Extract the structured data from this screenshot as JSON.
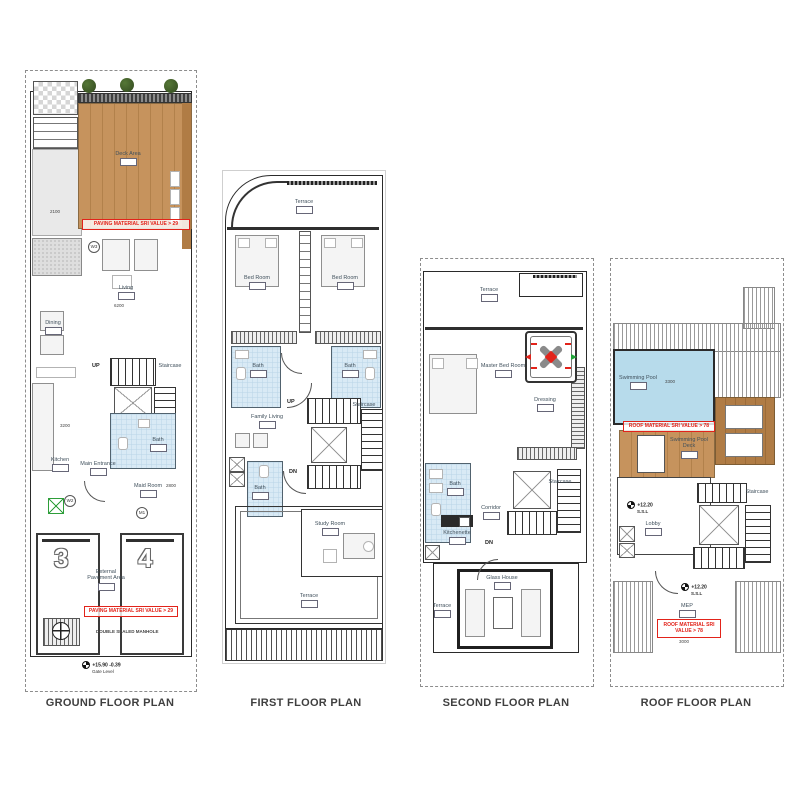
{
  "titles": {
    "ground": "GROUND FLOOR PLAN",
    "first": "FIRST FLOOR PLAN",
    "second": "SECOND FLOOR PLAN",
    "roof": "ROOF FLOOR PLAN"
  },
  "ground": {
    "deck_area": "Deck Area",
    "living": "Living",
    "dining": "Dining",
    "kitchen": "Kitchen",
    "main_entrance": "Main Entrance",
    "bath": "Bath",
    "maid_room": "Maid Room",
    "staircase": "Staircase",
    "up": "UP",
    "parking_3": "3",
    "parking_4": "4",
    "external_pavement": "External Pavement Area",
    "manhole_note": "DOUBLE SEALED MANHOLE",
    "paving_note": "PAVING MATERIAL SRI VALUE > 29",
    "paving_note_2": "PAVING MATERIAL SRI VALUE > 29",
    "level": "+15.90  -0.39",
    "level_sub": "Gate Level",
    "tag_w3": "W3",
    "tag_w2": "W2",
    "tag_m1": "M1",
    "dim_a": "2100",
    "dim_b": "6200",
    "dim_c": "3200",
    "dim_d": "2800"
  },
  "first": {
    "terrace_top": "Terrace",
    "bedroom_l": "Bed Room",
    "bedroom_r": "Bed Room",
    "bath_l": "Bath",
    "bath_r": "Bath",
    "family_living": "Family Living",
    "bath_s": "Bath",
    "study": "Study Room",
    "terrace_bottom": "Terrace",
    "staircase": "Staircase",
    "up": "UP",
    "dn": "DN"
  },
  "second": {
    "terrace_top": "Terrace",
    "master": "Master Bed Room",
    "dressing": "Dressing",
    "bath": "Bath",
    "corridor": "Corridor",
    "kitchenette": "Kitchenette",
    "staircase": "Staircase",
    "dn": "DN",
    "glass_house": "Glass House",
    "terrace_side": "Terrace"
  },
  "roof": {
    "pool": "Swimming Pool",
    "pool_deck": "Swimming Pool Deck",
    "lobby": "Lobby",
    "staircase": "Staircase",
    "mep": "MEP",
    "level_a": "+12.20",
    "level_a_sub": "S.S.L",
    "level_b": "+12.20",
    "level_b_sub": "S.S.L",
    "note": "ROOF MATERIAL SRI VALUE > 78",
    "note_2": "ROOF MATERIAL SRI VALUE > 78",
    "dim_pool": "3300",
    "dim_mep": "3000"
  }
}
